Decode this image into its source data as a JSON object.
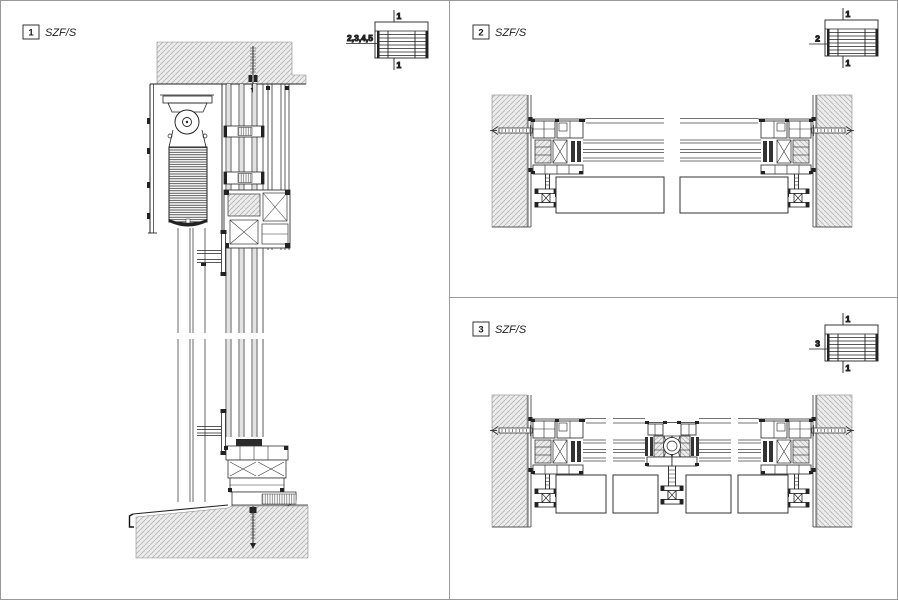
{
  "document_type": "window-system-section-details",
  "system_name": "SZF/S",
  "colors": {
    "background": "#ffffff",
    "line": "#222222",
    "frame_border": "#9a9a9a",
    "wall_fill": "#ececec",
    "hatch_line": "#b3b3b3",
    "glass_band": "#e2e2e2",
    "dark_fill": "#2a2a2a"
  },
  "panels": [
    {
      "number": "1",
      "title": "SZF/S",
      "key": {
        "section_label_top": "1",
        "section_label_bottom": "1",
        "side_label": "2,3,4,5"
      }
    },
    {
      "number": "2",
      "title": "SZF/S",
      "key": {
        "section_label_top": "1",
        "section_label_bottom": "1",
        "side_label": "2"
      }
    },
    {
      "number": "3",
      "title": "SZF/S",
      "key": {
        "section_label_top": "1",
        "section_label_bottom": "1",
        "side_label": "3"
      }
    }
  ]
}
